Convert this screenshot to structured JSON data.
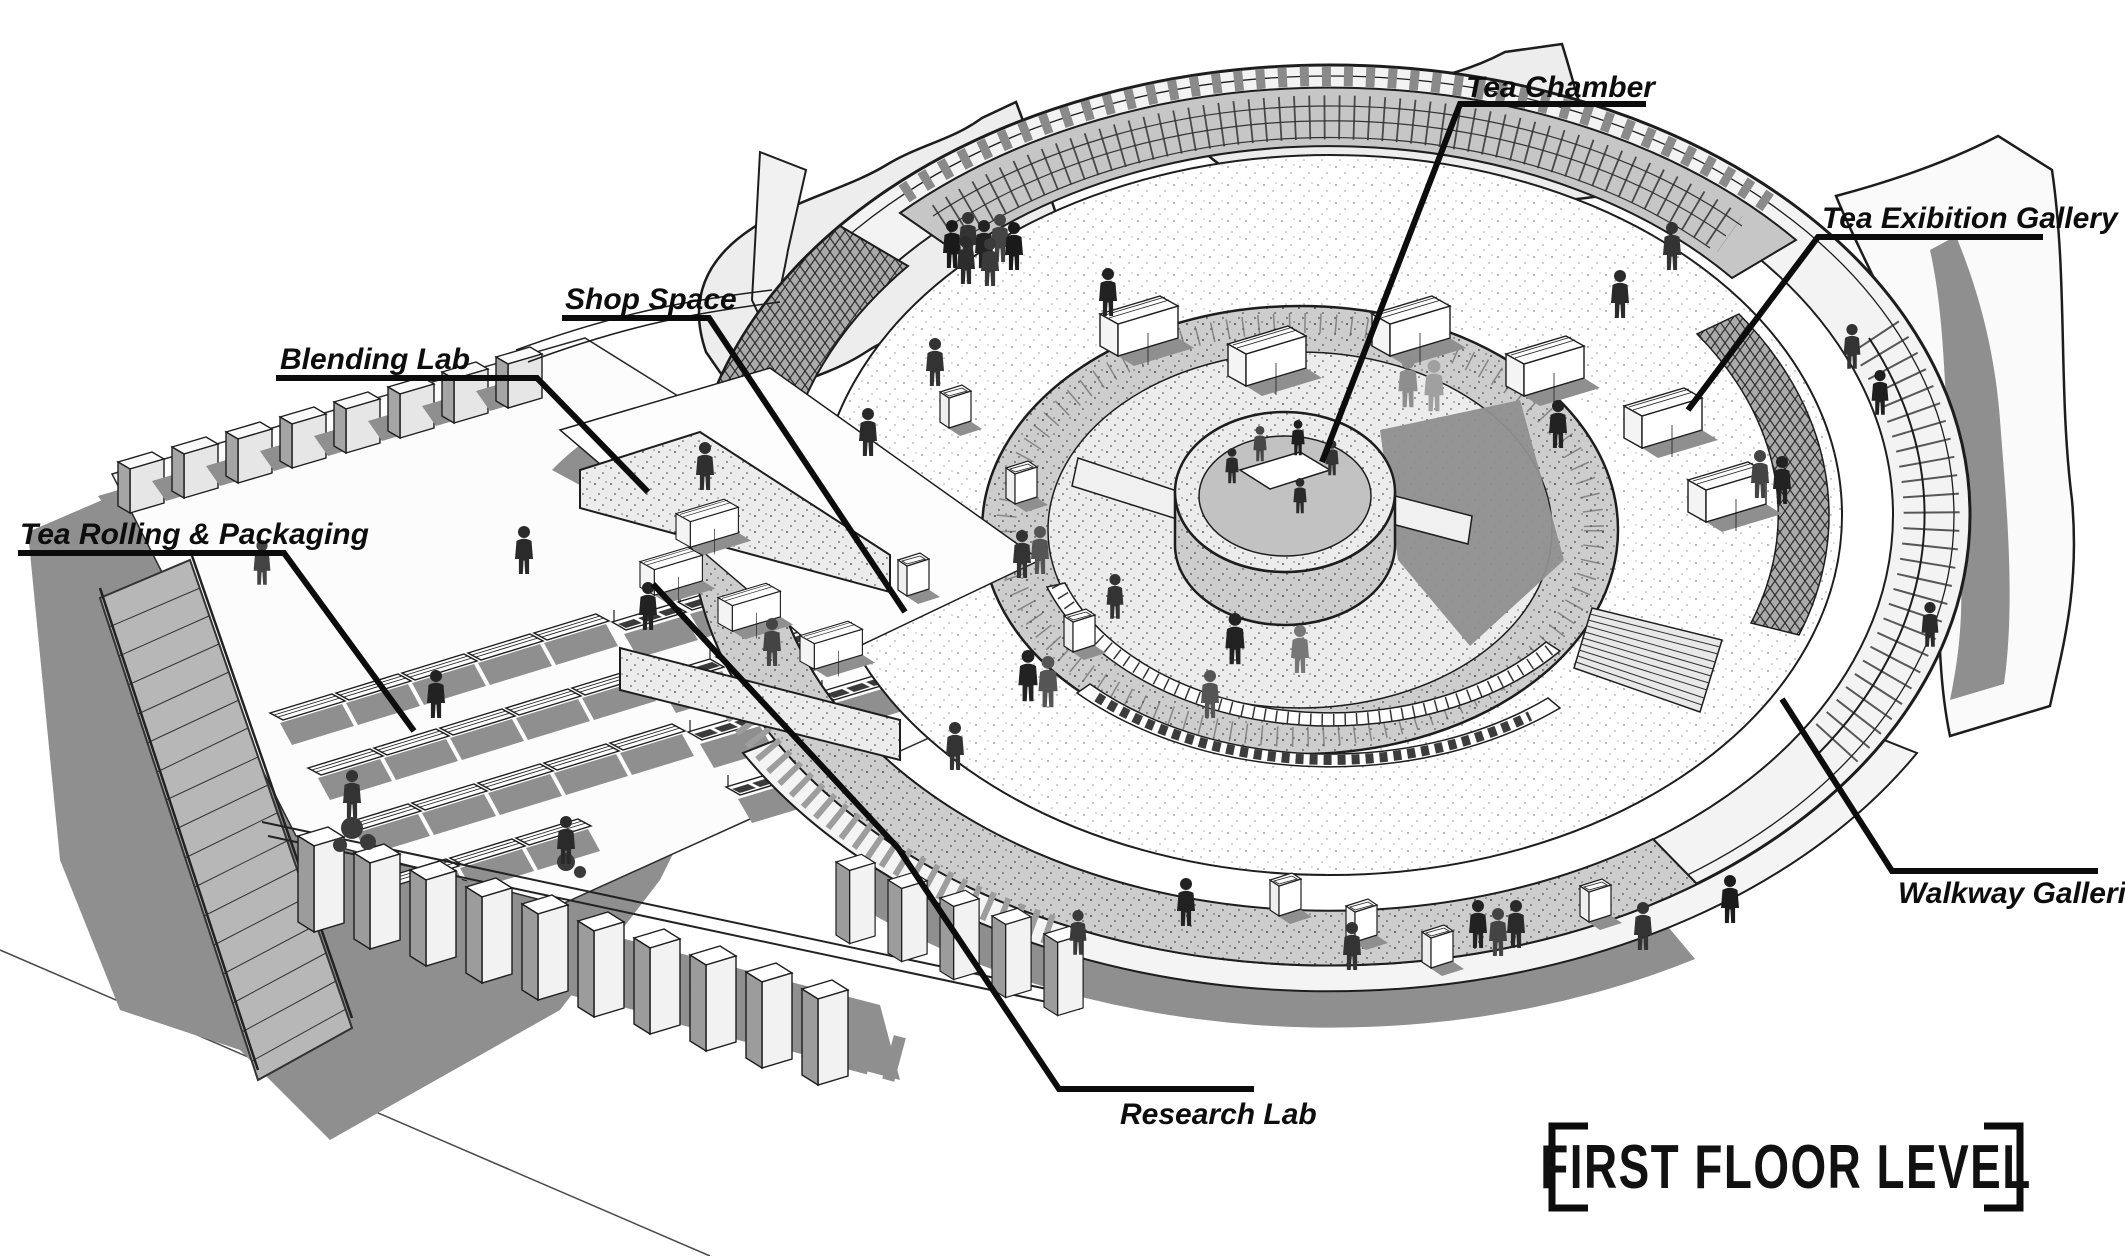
{
  "diagram": {
    "title": "FIRST FLOOR LEVEL",
    "labels": {
      "tea_chamber": "Tea Chamber",
      "tea_exibition_gallery": "Tea Exibition Gallery",
      "shop_space": "Shop Space",
      "blending_lab": "Blending Lab",
      "tea_rolling_packaging": "Tea Rolling & Packaging",
      "walkway_galleries": "Walkway Galleries",
      "research_lab": "Research Lab"
    },
    "colors": {
      "ink": "#111111",
      "shadow": "#8f8f8f",
      "canopy": "#ececec",
      "background": "#ffffff"
    }
  }
}
